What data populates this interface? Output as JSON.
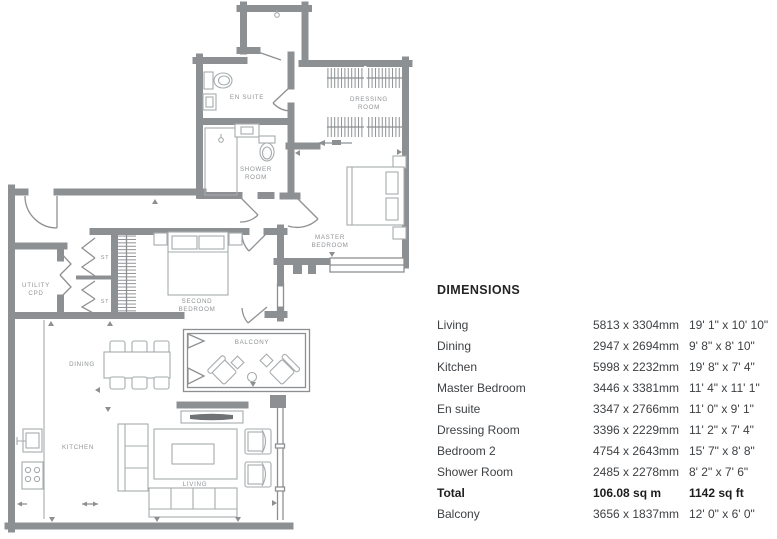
{
  "colors": {
    "wall_gray": "#8d9093",
    "furniture_gray": "#a6abae",
    "label_gray": "#8f9396",
    "table_text": "#3e4144",
    "table_heading": "#242424"
  },
  "floor_plan": {
    "labels": {
      "en_suite": "EN SUITE",
      "dressing_room_line1": "DRESSING",
      "dressing_room_line2": "ROOM",
      "shower_room_line1": "SHOWER",
      "shower_room_line2": "ROOM",
      "master_bedroom_line1": "MASTER",
      "master_bedroom_line2": "BEDROOM",
      "second_bedroom_line1": "SECOND",
      "second_bedroom_line2": "BEDROOM",
      "utility_line1": "UTILITY",
      "utility_line2": "CPD",
      "st_upper": "ST",
      "st_lower": "ST",
      "balcony": "BALCONY",
      "dining": "DINING",
      "kitchen": "KITCHEN",
      "living": "LIVING"
    }
  },
  "dimensions_table": {
    "title": "DIMENSIONS",
    "rows": [
      {
        "name": "Living",
        "metric": "5813 x 3304mm",
        "imperial": "19' 1\" x 10' 10\"",
        "bold": false
      },
      {
        "name": "Dining",
        "metric": "2947 x 2694mm",
        "imperial": "9' 8\" x 8' 10\"",
        "bold": false
      },
      {
        "name": "Kitchen",
        "metric": "5998 x 2232mm",
        "imperial": "19' 8\" x 7' 4\"",
        "bold": false
      },
      {
        "name": "Master Bedroom",
        "metric": "3446 x 3381mm",
        "imperial": "11' 4\" x 11' 1\"",
        "bold": false
      },
      {
        "name": "En suite",
        "metric": "3347 x 2766mm",
        "imperial": "11' 0\" x 9' 1\"",
        "bold": false
      },
      {
        "name": "Dressing Room",
        "metric": "3396 x 2229mm",
        "imperial": "11' 2\" x 7' 4\"",
        "bold": false
      },
      {
        "name": "Bedroom 2",
        "metric": "4754 x 2643mm",
        "imperial": "15' 7\" x 8' 8\"",
        "bold": false
      },
      {
        "name": "Shower Room",
        "metric": "2485 x 2278mm",
        "imperial": "8' 2\" x 7' 6\"",
        "bold": false
      },
      {
        "name": "Total",
        "metric": "106.08 sq m",
        "imperial": "1142 sq ft",
        "bold": true
      },
      {
        "name": "Balcony",
        "metric": "3656 x 1837mm",
        "imperial": "12' 0\" x 6' 0\"",
        "bold": false
      }
    ]
  }
}
